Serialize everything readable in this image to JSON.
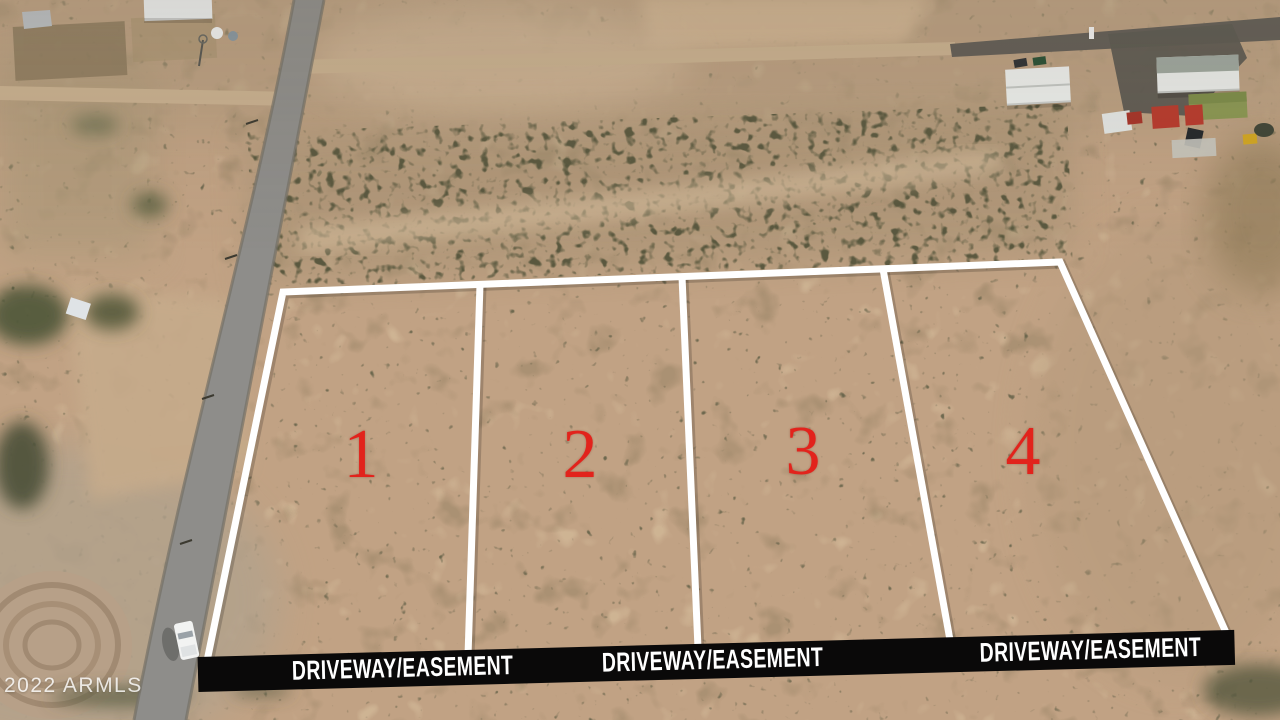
{
  "photo": {
    "description": "Aerial drone photo of four desert land parcels outlined in white beside a paved road",
    "width_px": 1280,
    "height_px": 720
  },
  "lots": [
    {
      "number": "1"
    },
    {
      "number": "2"
    },
    {
      "number": "3"
    },
    {
      "number": "4"
    }
  ],
  "banner": {
    "segments": [
      {
        "label": "DRIVEWAY/EASEMENT"
      },
      {
        "label": "DRIVEWAY/EASEMENT"
      },
      {
        "label": "DRIVEWAY/EASEMENT"
      }
    ]
  },
  "watermark": {
    "text": "2022 ARMLS"
  },
  "colors": {
    "lot_line": "#ffffff",
    "lot_number": "#e2231c",
    "banner_background": "#0a0909",
    "banner_text": "#ffffff",
    "watermark_text": "#ffffff",
    "desert_base": "#c1a284",
    "paved_road": "#8e8d8a"
  }
}
